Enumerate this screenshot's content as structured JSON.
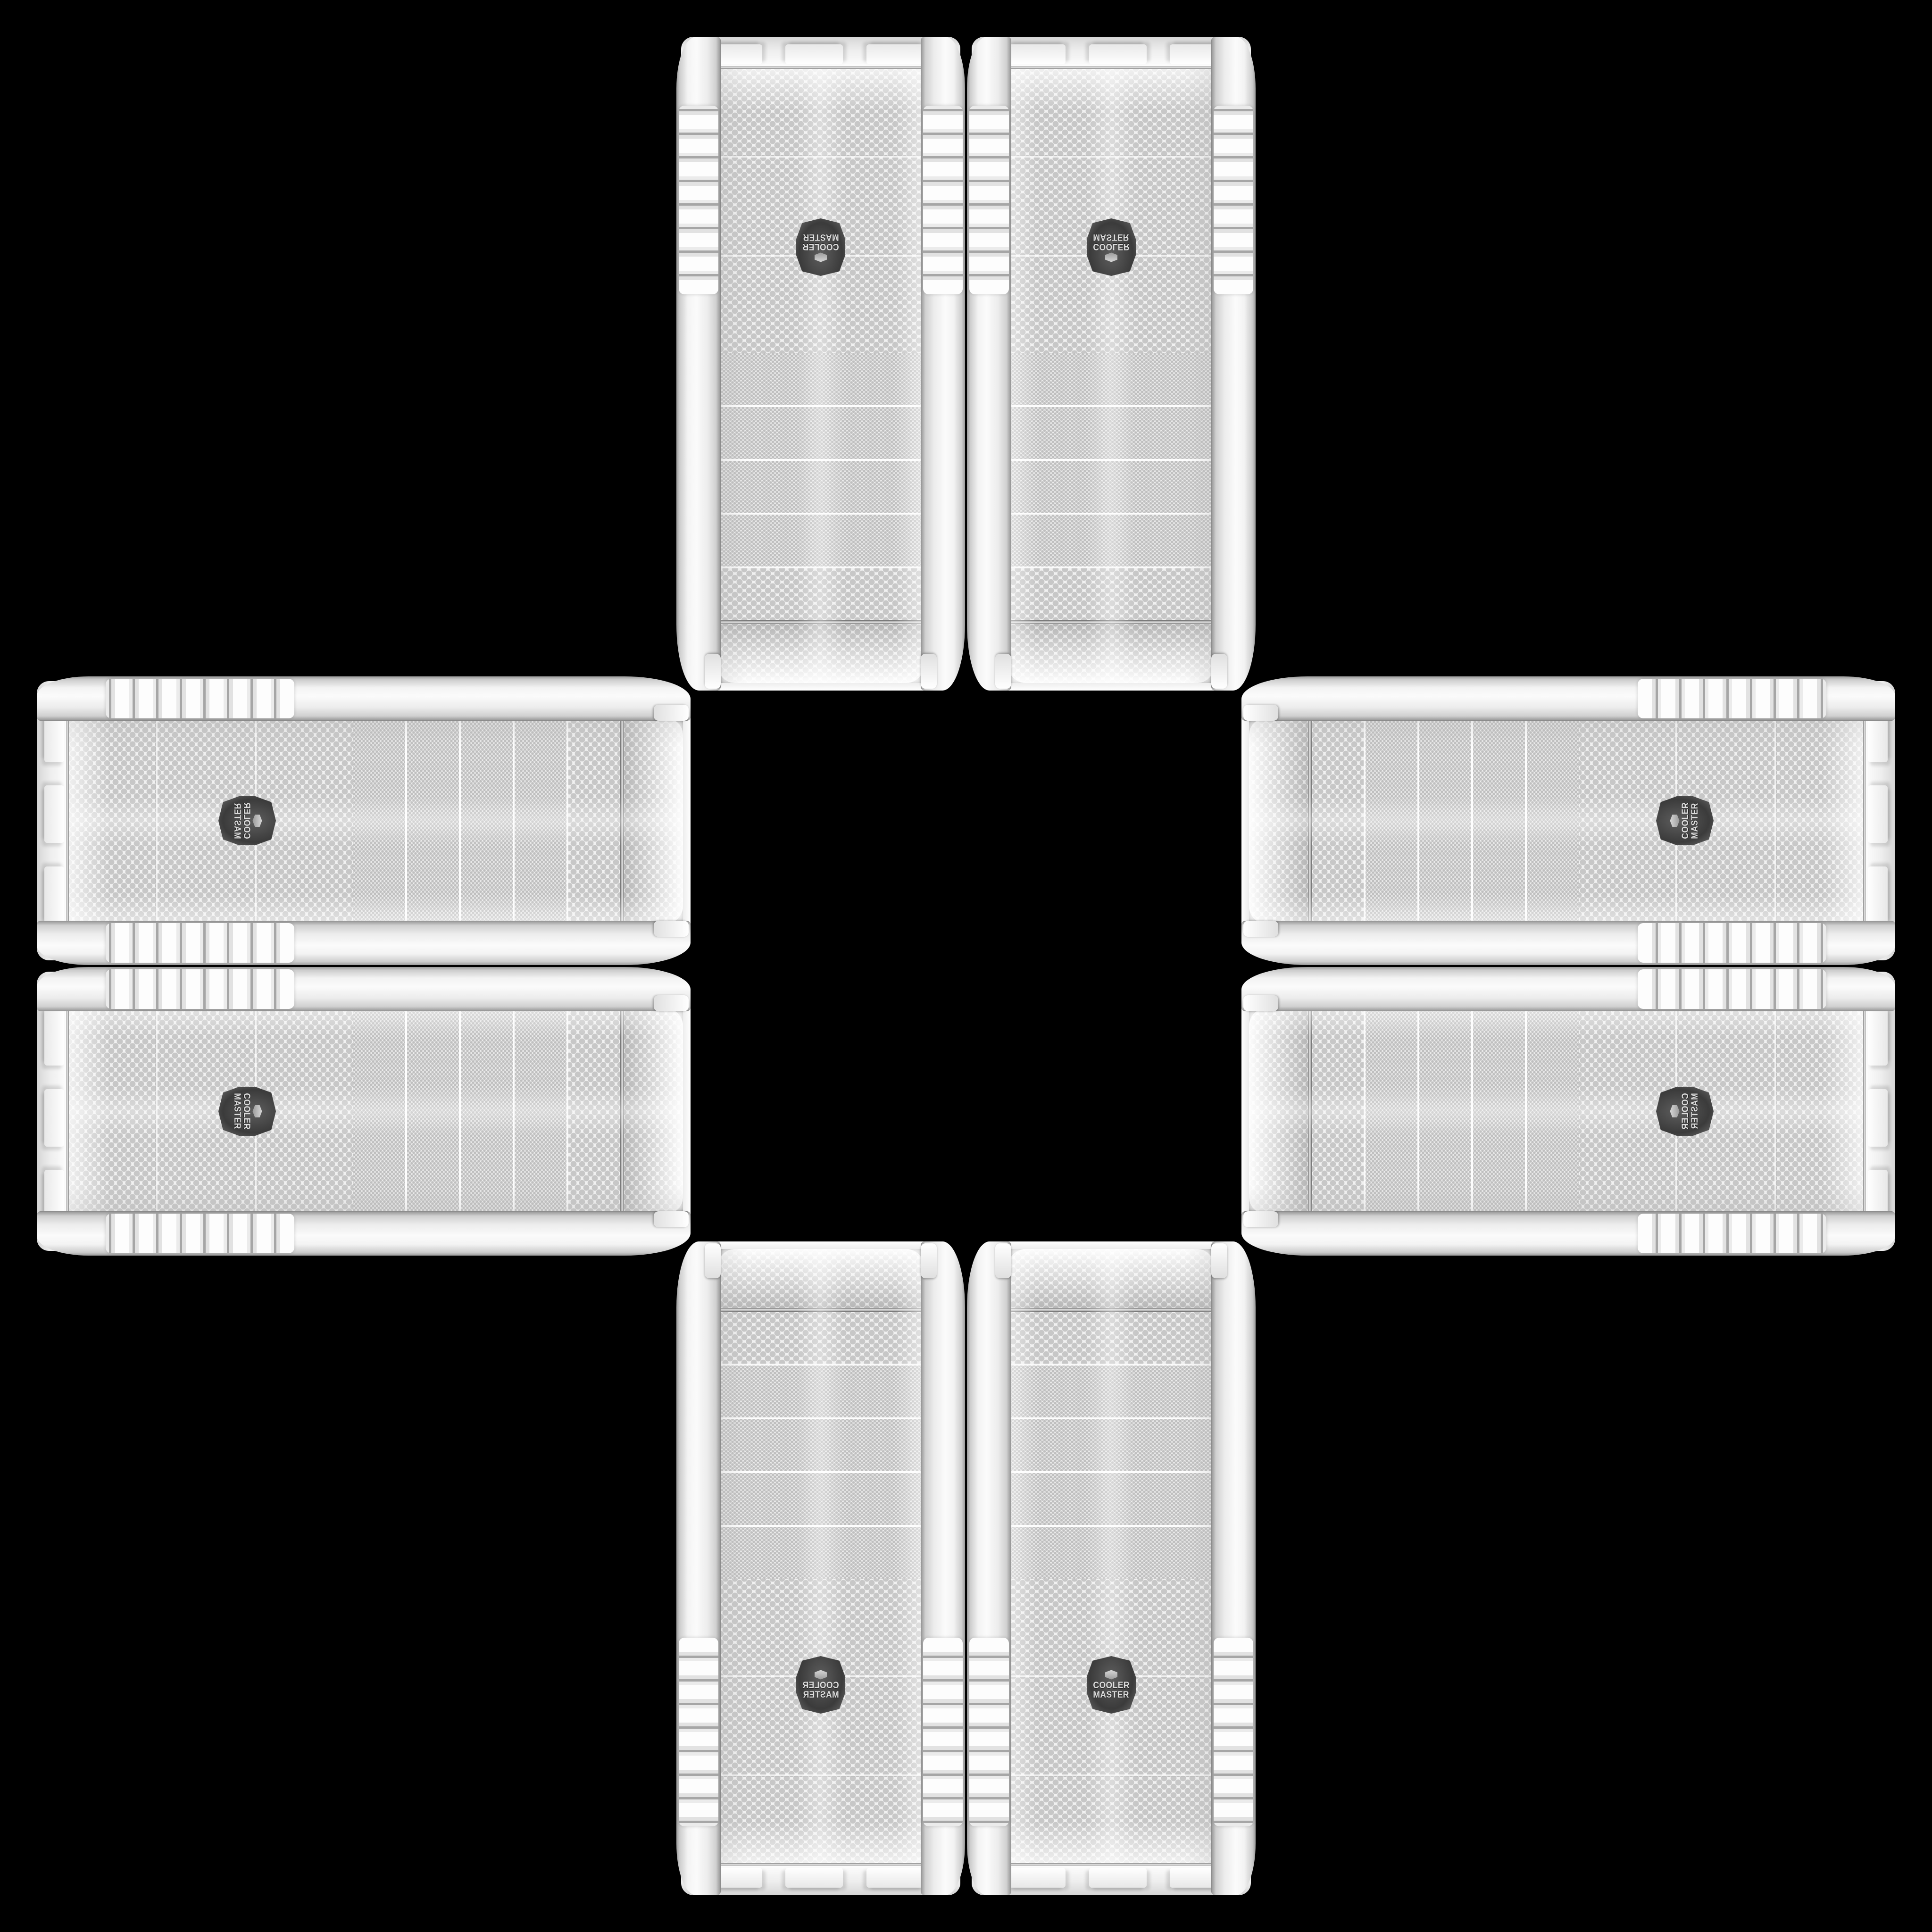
{
  "page": {
    "background_color": "#000000",
    "description": "Eight white Cooler Master computer-case front mesh panels arranged in a cross (plus) pattern on a black background; mirrored pairs on top, bottom, left and right arms with an empty black square in the center"
  },
  "brand": {
    "line1": "COOLER",
    "line2": "MASTER"
  },
  "colors": {
    "background": "#000000",
    "panel_white": "#f2f2f2",
    "mesh_dot_gray": "#c7c7c7",
    "chrome_trim": "#c9c9c9",
    "badge_dark": "#3b3b3b",
    "badge_text": "#dcdcdc"
  },
  "panels": [
    {
      "id": "top-left",
      "orientation": "vertical",
      "mirror": "rotated-180"
    },
    {
      "id": "top-right",
      "orientation": "vertical",
      "mirror": "flipped-vertically"
    },
    {
      "id": "left-top",
      "orientation": "horizontal",
      "mirror": "flipped-vertically"
    },
    {
      "id": "left-bottom",
      "orientation": "horizontal",
      "mirror": "none"
    },
    {
      "id": "right-top",
      "orientation": "horizontal",
      "mirror": "rotated-180"
    },
    {
      "id": "right-bottom",
      "orientation": "horizontal",
      "mirror": "flipped-horizontally"
    },
    {
      "id": "bottom-left",
      "orientation": "vertical",
      "mirror": "flipped-horizontally"
    },
    {
      "id": "bottom-right",
      "orientation": "vertical",
      "mirror": "none"
    }
  ]
}
